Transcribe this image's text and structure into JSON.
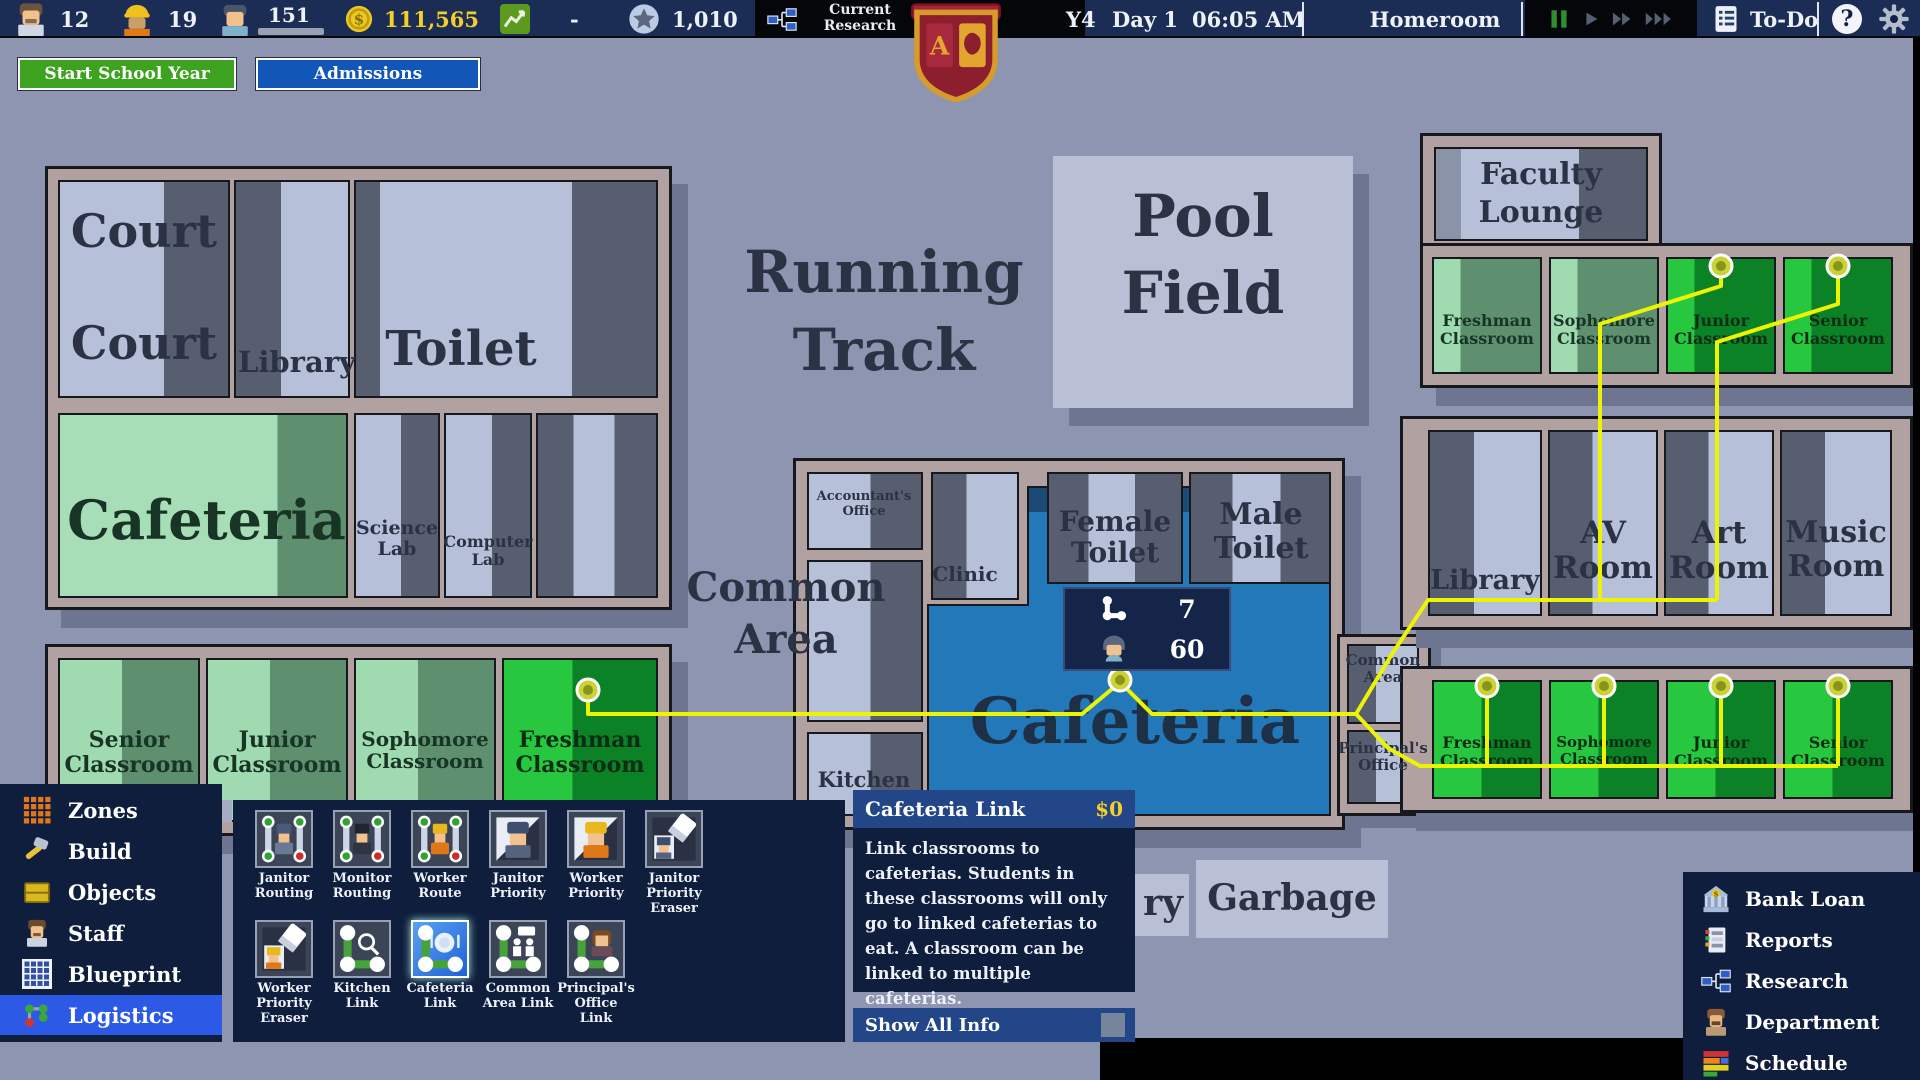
{
  "topbar": {
    "teachers": "12",
    "workers": "19",
    "students": "151",
    "money": "111,565",
    "net": "-",
    "points": "1,010",
    "current_research": "Current Research",
    "year": "Y4",
    "day": "Day 1",
    "time": "06:05 AM",
    "period": "Homeroom",
    "todo_label": "To-Do",
    "help_label": "?"
  },
  "actions": {
    "start_year": "Start School Year",
    "admissions": "Admissions"
  },
  "map": {
    "zones": {
      "court1": "Court",
      "court2": "Court",
      "library_left": "Library",
      "toilet_left": "Toilet",
      "cafeteria_left": "Cafeteria",
      "science_lab": "Science Lab",
      "computer_lab": "Computer Lab",
      "senior_bl": "Senior Classroom",
      "junior_bl": "Junior Classroom",
      "sophomore_bl": "Sophomore Classroom",
      "freshman_bl": "Freshman Classroom",
      "running_track": "Running Track",
      "pool_field": "Pool Field",
      "accountants_office": "Accountant's Office",
      "clinic": "Clinic",
      "common_area_left": "Common Area",
      "kitchen": "Kitchen",
      "cafeteria_center": "Cafeteria",
      "female_toilet": "Female Toilet",
      "male_toilet": "Male Toilet",
      "faculty_lounge": "Faculty Lounge",
      "freshman_tr": "Freshman Classroom",
      "sophomore_tr": "Sophomore Classroom",
      "junior_tr": "Junior Classroom",
      "senior_tr": "Senior Classroom",
      "library_right": "Library",
      "av_room": "AV Room",
      "art_room": "Art Room",
      "music_room": "Music Room",
      "freshman_br": "Freshman Classroom",
      "sophomore_br": "Sophomore Classroom",
      "junior_br": "Junior Classroom",
      "senior_br": "Senior Classroom",
      "common_area_right": "Common Area",
      "principals_office": "Principal's Office",
      "garbage": "Garbage",
      "partial_label": "ry"
    },
    "link_info": {
      "links": "7",
      "students": "60"
    }
  },
  "left_menu": {
    "items": [
      {
        "name": "zones",
        "icon": "zones",
        "label": "Zones"
      },
      {
        "name": "build",
        "icon": "build",
        "label": "Build"
      },
      {
        "name": "objects",
        "icon": "objects",
        "label": "Objects"
      },
      {
        "name": "staff",
        "icon": "staff",
        "label": "Staff"
      },
      {
        "name": "blueprint",
        "icon": "blueprint",
        "label": "Blueprint"
      },
      {
        "name": "logistics",
        "icon": "logistics",
        "label": "Logistics"
      }
    ]
  },
  "toolbar": {
    "row1": [
      {
        "name": "janitor-routing",
        "icon": "janitor-routing",
        "label": "Janitor Routing"
      },
      {
        "name": "monitor-routing",
        "icon": "monitor-routing",
        "label": "Monitor Routing"
      },
      {
        "name": "worker-route",
        "icon": "worker-route",
        "label": "Worker Route"
      },
      {
        "name": "janitor-priority",
        "icon": "janitor-priority",
        "label": "Janitor Priority"
      },
      {
        "name": "worker-priority",
        "icon": "worker-priority",
        "label": "Worker Priority"
      },
      {
        "name": "janitor-priority-eraser",
        "icon": "janitor-eraser",
        "label": "Janitor Priority Eraser"
      }
    ],
    "row2": [
      {
        "name": "worker-priority-eraser",
        "icon": "worker-eraser",
        "label": "Worker Priority Eraser"
      },
      {
        "name": "kitchen-link",
        "icon": "kitchen-link",
        "label": "Kitchen Link"
      },
      {
        "name": "cafeteria-link",
        "icon": "cafeteria-link",
        "label": "Cafeteria Link",
        "selected": true
      },
      {
        "name": "common-area-link",
        "icon": "common-link",
        "label": "Common Area Link"
      },
      {
        "name": "principals-office-link",
        "icon": "principal-link",
        "label": "Principal's Office Link"
      }
    ]
  },
  "tool_tooltip": {
    "title": "Cafeteria Link",
    "cost": "$0",
    "body": "Link classrooms to cafeterias. Students in these classrooms will only go to linked cafeterias to eat. A classroom can be linked to multiple cafeterias.",
    "footer": "Show All Info"
  },
  "right_menu": {
    "items": [
      {
        "name": "bank-loan",
        "icon": "bank",
        "label": "Bank Loan"
      },
      {
        "name": "reports",
        "icon": "reports",
        "label": "Reports"
      },
      {
        "name": "research",
        "icon": "research",
        "label": "Research"
      },
      {
        "name": "department",
        "icon": "department",
        "label": "Department"
      },
      {
        "name": "schedule",
        "icon": "schedule",
        "label": "Schedule"
      }
    ]
  }
}
